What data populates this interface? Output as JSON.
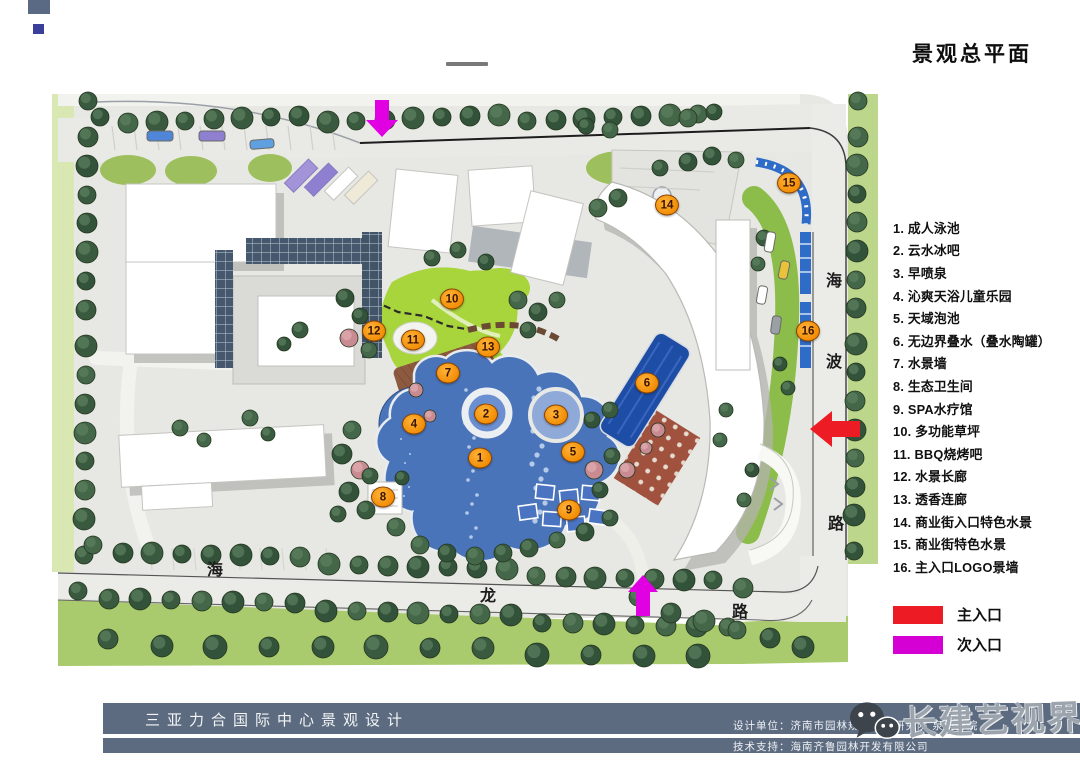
{
  "header": {
    "sheet_title": "景观总平面"
  },
  "decor": {
    "square_top_color": "#5a6a85",
    "square_bottom_color": "#3a3f9c"
  },
  "legend": {
    "items": [
      {
        "num": "1",
        "label": "成人泳池"
      },
      {
        "num": "2",
        "label": "云水冰吧"
      },
      {
        "num": "3",
        "label": "早喷泉"
      },
      {
        "num": "4",
        "label": "沁爽天浴儿童乐园"
      },
      {
        "num": "5",
        "label": "天域泡池"
      },
      {
        "num": "6",
        "label": "无边界叠水（叠水陶罐）"
      },
      {
        "num": "7",
        "label": "水景墙"
      },
      {
        "num": "8",
        "label": "生态卫生间"
      },
      {
        "num": "9",
        "label": "SPA水疗馆"
      },
      {
        "num": "10",
        "label": "多功能草坪"
      },
      {
        "num": "11",
        "label": "BBQ烧烤吧"
      },
      {
        "num": "12",
        "label": "水景长廊"
      },
      {
        "num": "13",
        "label": "透香连廊"
      },
      {
        "num": "14",
        "label": "商业街入口特色水景"
      },
      {
        "num": "15",
        "label": "商业街特色水景"
      },
      {
        "num": "16",
        "label": "主入口LOGO景墙"
      }
    ]
  },
  "entrances": {
    "main": {
      "label": "主入口",
      "color": "#ed1c24"
    },
    "secondary": {
      "label": "次入口",
      "color": "#d400d4"
    }
  },
  "plan": {
    "roads": {
      "right": [
        "海",
        "波",
        "路"
      ],
      "bottom": [
        "海",
        "龙",
        "路"
      ]
    },
    "markers": [
      {
        "n": "1",
        "x": 480,
        "y": 458
      },
      {
        "n": "2",
        "x": 486,
        "y": 414
      },
      {
        "n": "3",
        "x": 556,
        "y": 415
      },
      {
        "n": "4",
        "x": 414,
        "y": 424
      },
      {
        "n": "5",
        "x": 573,
        "y": 452
      },
      {
        "n": "6",
        "x": 647,
        "y": 383
      },
      {
        "n": "7",
        "x": 448,
        "y": 373
      },
      {
        "n": "8",
        "x": 383,
        "y": 497
      },
      {
        "n": "9",
        "x": 569,
        "y": 510
      },
      {
        "n": "10",
        "x": 452,
        "y": 299
      },
      {
        "n": "11",
        "x": 413,
        "y": 340
      },
      {
        "n": "12",
        "x": 374,
        "y": 331
      },
      {
        "n": "13",
        "x": 488,
        "y": 347
      },
      {
        "n": "14",
        "x": 667,
        "y": 205
      },
      {
        "n": "15",
        "x": 789,
        "y": 183
      },
      {
        "n": "16",
        "x": 808,
        "y": 331
      }
    ],
    "arrows": [
      {
        "name": "secondary-entrance-arrow-top",
        "direction": "down",
        "color": "#e100e1"
      },
      {
        "name": "secondary-entrance-arrow-bottom",
        "direction": "up",
        "color": "#e100e1"
      },
      {
        "name": "main-entrance-arrow",
        "direction": "left",
        "color": "#ed1c24"
      }
    ]
  },
  "footer": {
    "bar_color": "#5c6b7f",
    "project_title": "三亚力合国际中心景观设计",
    "design_credit": "设计单位：济南市园林规划设计研究院 泉新分院",
    "support_credit": "技术支持：海南齐鲁园林开发有限公司"
  },
  "watermark": {
    "text": "长建艺视界"
  }
}
